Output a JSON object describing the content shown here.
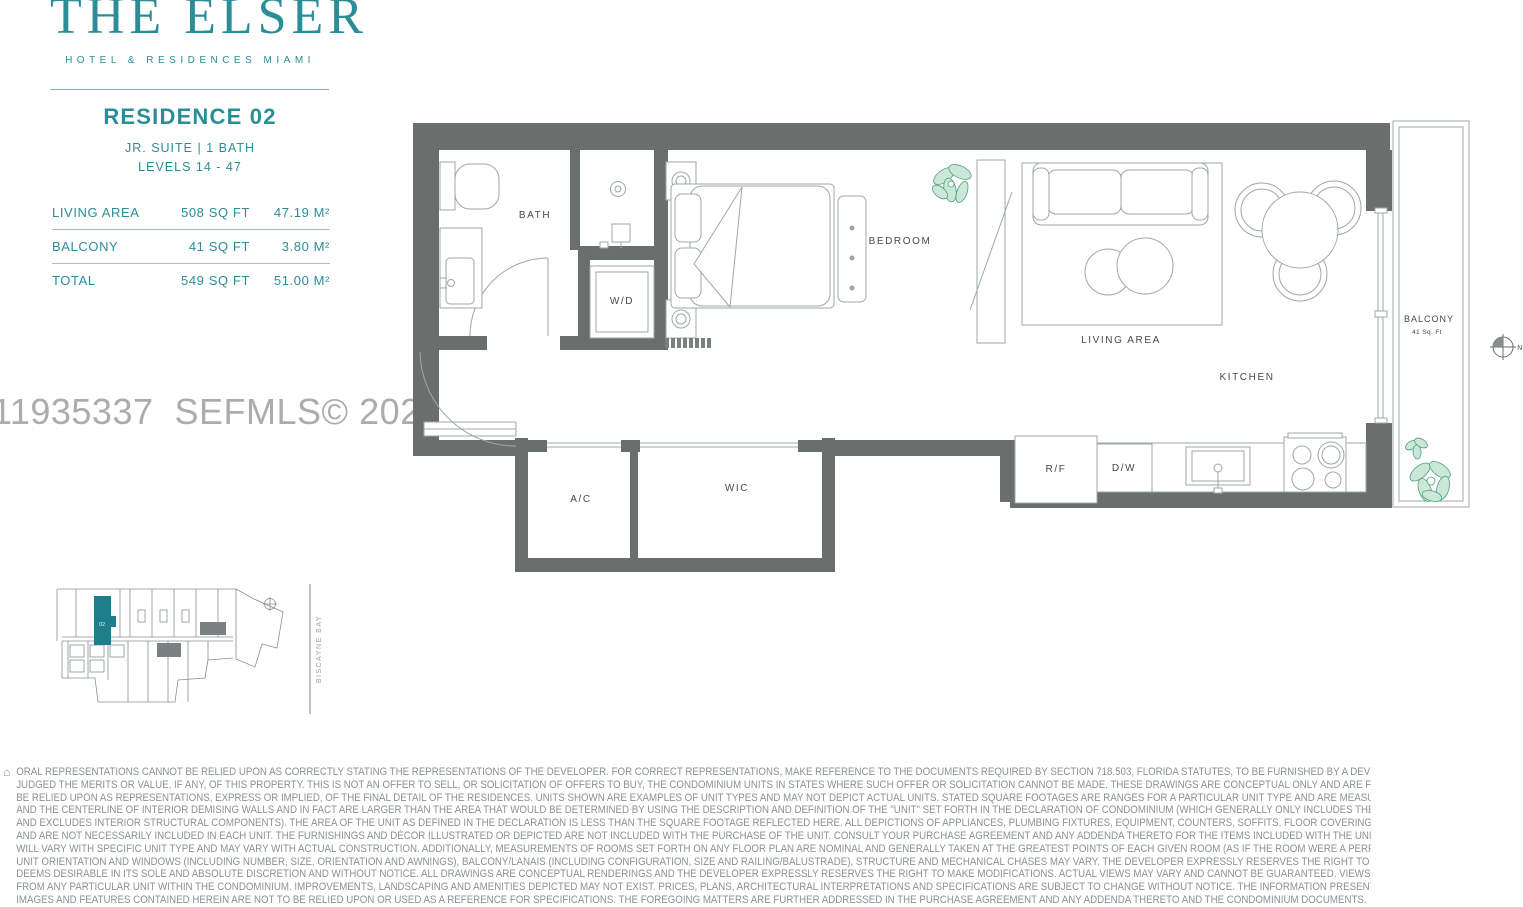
{
  "brand": {
    "logo": "THE ELSER",
    "tagline": "HOTEL & RESIDENCES MIAMI"
  },
  "residence": {
    "title": "RESIDENCE 02",
    "subtitle": "JR. SUITE | 1 BATH",
    "levels": "LEVELS 14 - 47"
  },
  "areas": {
    "rows": [
      {
        "label": "LIVING AREA",
        "sqft": "508 SQ FT",
        "sqm": "47.19 M²"
      },
      {
        "label": "BALCONY",
        "sqft": "41 SQ FT",
        "sqm": "3.80 M²"
      },
      {
        "label": "TOTAL",
        "sqft": "549 SQ FT",
        "sqm": "51.00 M²"
      }
    ]
  },
  "watermark": "11935337  SEFMLS© 2025",
  "floorplan": {
    "labels": {
      "bath": "BATH",
      "wd": "W/D",
      "bedroom": "BEDROOM",
      "living": "LIVING AREA",
      "kitchen": "KITCHEN",
      "ac": "A/C",
      "wic": "WIC",
      "rf": "R/F",
      "dw": "D/W",
      "balcony": "BALCONY",
      "balcony_area": "41 Sq. Ft",
      "north": "N"
    }
  },
  "keyplan": {
    "unit_label": "02",
    "bay_label": "BISCAYNE BAY"
  },
  "icons": {
    "equal_housing": "⌂"
  },
  "colors": {
    "brand_teal": "#2B8D96",
    "keyplan_teal": "#1F7E8C",
    "wall_gray": "#6A6F6D",
    "furniture_line": "#9FA7A6",
    "label_gray": "#464B4C",
    "watermark_gray": "#ACACAC",
    "disclaimer_gray": "#8C9194",
    "plant_fill": "#CBE7D6",
    "plant_stroke": "#4E9E86"
  },
  "disclaimer": {
    "lines": [
      "ORAL REPRESENTATIONS CANNOT BE RELIED UPON AS CORRECTLY STATING THE REPRESENTATIONS OF THE DEVELOPER. FOR CORRECT REPRESENTATIONS, MAKE REFERENCE TO THE DOCUMENTS REQUIRED BY SECTION 718.503, FLORIDA STATUTES, TO BE FURNISHED BY A DEVELOPER TO A BUYER OR LESSEE. NO FEDERAL AGENCY HAS",
      "JUDGED THE MERITS OR VALUE, IF ANY, OF THIS PROPERTY. THIS IS NOT AN OFFER TO SELL, OR SOLICITATION OF OFFERS TO BUY, THE CONDOMINIUM UNITS IN STATES WHERE SUCH OFFER OR SOLICITATION CANNOT BE MADE. THESE DRAWINGS ARE CONCEPTUAL ONLY AND ARE FOR THE CONVENIENCE OF REFERENCE. THEY SHOULD NOT",
      "BE RELIED UPON AS REPRESENTATIONS, EXPRESS OR IMPLIED, OF THE FINAL DETAIL OF THE RESIDENCES. UNITS SHOWN ARE EXAMPLES OF UNIT TYPES AND MAY NOT DEPICT ACTUAL UNITS. STATED SQUARE FOOTAGES ARE RANGES FOR A PARTICULAR UNIT TYPE AND ARE MEASURED TO THE EXTERIOR BOUNDARIES OF THE EXTERIOR WALLS",
      "AND THE CENTERLINE OF INTERIOR DEMISING WALLS AND IN FACT ARE LARGER THAN THE AREA THAT WOULD BE DETERMINED BY USING THE DESCRIPTION AND DEFINITION OF THE \"UNIT\" SET FORTH IN THE DECLARATION OF CONDOMINIUM (WHICH GENERALLY ONLY INCLUDES THE INTERIOR AIRSPACE BETWEEN THE PERIMETER WALLS",
      "AND EXCLUDES INTERIOR STRUCTURAL COMPONENTS). THE AREA OF THE UNIT AS DEFINED IN THE DECLARATION IS LESS THAN THE SQUARE FOOTAGE REFLECTED HERE. ALL DEPICTIONS OF APPLIANCES, PLUMBING FIXTURES, EQUIPMENT, COUNTERS, SOFFITS, FLOOR COVERINGS AND OTHER MATTERS OF DETAIL ARE CONCEPTUAL ONLY",
      "AND ARE NOT NECESSARILY INCLUDED IN EACH UNIT. THE FURNISHINGS AND DÉCOR ILLUSTRATED OR DEPICTED ARE NOT INCLUDED WITH THE PURCHASE OF THE UNIT. CONSULT YOUR PURCHASE AGREEMENT AND ANY ADDENDA THERETO FOR THE ITEMS INCLUDED WITH THE UNIT. DIMENSIONS AND SQUARE FOOTAGE ARE APPROXIMATE,",
      "WILL VARY WITH SPECIFIC UNIT TYPE AND MAY VARY WITH ACTUAL CONSTRUCTION. ADDITIONALLY, MEASUREMENTS OF ROOMS SET FORTH ON ANY FLOOR PLAN ARE NOMINAL AND GENERALLY TAKEN AT THE GREATEST POINTS OF EACH GIVEN ROOM (AS IF THE ROOM WERE A PERFECT RECTANGLE), WITHOUT REGARD FOR ANY CUTOUTS.",
      "UNIT ORIENTATION AND WINDOWS (INCLUDING NUMBER, SIZE, ORIENTATION AND AWNINGS), BALCONY/LANAIS (INCLUDING CONFIGURATION, SIZE AND RAILING/BALUSTRADE), STRUCTURE AND MECHANICAL CHASES MAY VARY. THE DEVELOPER EXPRESSLY RESERVES THE RIGHT TO MAKE MODIFICATIONS, REVISIONS AND CHANGES IT",
      "DEEMS DESIRABLE IN ITS SOLE AND ABSOLUTE DISCRETION AND WITHOUT NOTICE. ALL DRAWINGS ARE CONCEPTUAL RENDERINGS AND THE DEVELOPER EXPRESSLY RESERVES THE RIGHT TO MAKE MODIFICATIONS. ACTUAL VIEWS MAY VARY AND CANNOT BE GUARANTEED. VIEWS SHOWN CANNOT BE RELIED UPON AS THE ACTUAL VIEW",
      "FROM ANY PARTICULAR UNIT WITHIN THE CONDOMINIUM. IMPROVEMENTS, LANDSCAPING AND AMENITIES DEPICTED MAY NOT EXIST. PRICES, PLANS, ARCHITECTURAL INTERPRETATIONS AND SPECIFICATIONS ARE SUBJECT TO CHANGE WITHOUT NOTICE. THE INFORMATION PRESENTED WITHIN THIS DOCUMENT IS CONCEPTUAL. THE",
      "IMAGES AND FEATURES CONTAINED HEREIN ARE NOT TO BE RELIED UPON OR USED AS A REFERENCE FOR SPECIFICATIONS. THE FOREGOING MATTERS ARE FURTHER ADDRESSED IN THE PURCHASE AGREEMENT AND ANY ADDENDA THERETO AND THE CONDOMINIUM DOCUMENTS."
    ]
  }
}
